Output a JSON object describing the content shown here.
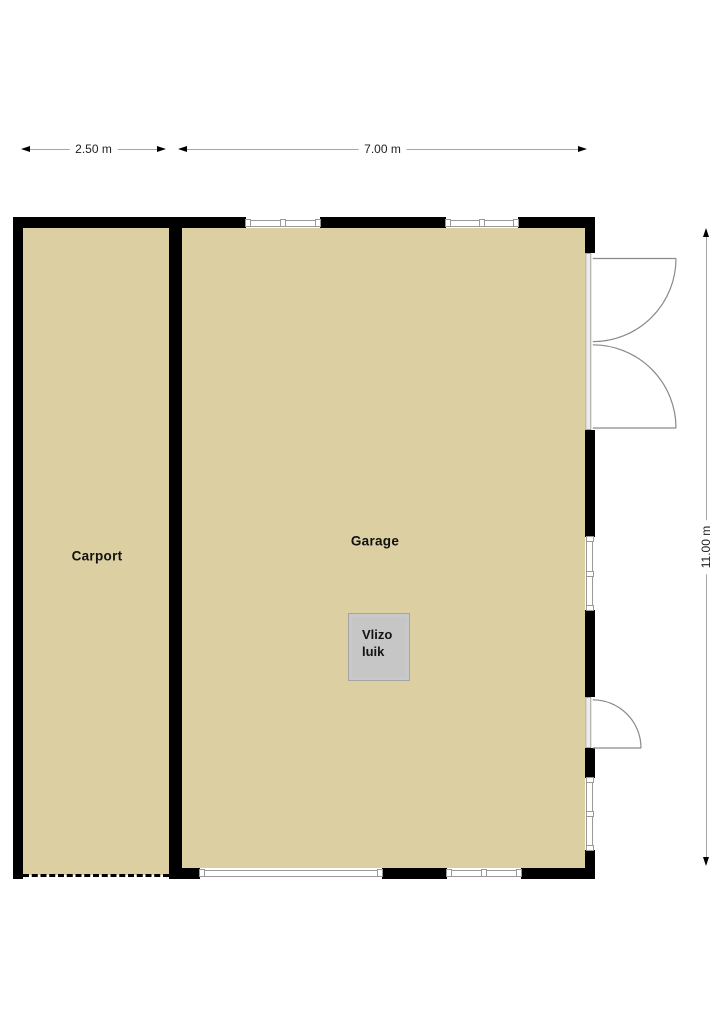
{
  "floorplan": {
    "rooms": {
      "carport": {
        "label": "Carport"
      },
      "garage": {
        "label": "Garage"
      }
    },
    "features": {
      "attic_hatch": {
        "label": "Vlizo luik"
      }
    },
    "dimensions": {
      "carport_width": "2.50 m",
      "garage_width": "7.00 m",
      "depth": "11.00 m"
    },
    "icons": {
      "dimension_arrows": "arrow-icon",
      "door_swings": "door-arc-icon"
    },
    "colors": {
      "floor": "#dccfa2",
      "wall": "#000000",
      "window_frame": "#9a9a9a",
      "hatch_fill": "#c6c6c6",
      "hatch_frame": "#c9c9c9",
      "dim_line": "#a6a6a6",
      "dim_text": "#1f1f1f",
      "door_line": "#8a8a8a",
      "label_text": "#111111"
    }
  }
}
